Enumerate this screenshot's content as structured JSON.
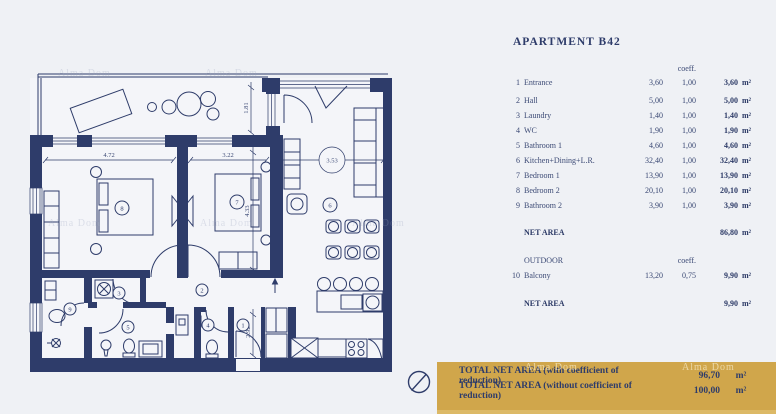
{
  "title": "APARTMENT B42",
  "watermark": "Alma Dom",
  "colors": {
    "wall_navy": "#2e3c6a",
    "banner_gold": "#d0a64b",
    "text_navy": "#3c4a75"
  },
  "table": {
    "coeff_header": "coeff.",
    "unit": "m²",
    "rows": [
      {
        "num": "1",
        "name": "Entrance",
        "area": "3,60",
        "coeff": "1,00",
        "net": "3,60"
      },
      {
        "num": "2",
        "name": "Hall",
        "area": "5,00",
        "coeff": "1,00",
        "net": "5,00"
      },
      {
        "num": "3",
        "name": "Laundry",
        "area": "1,40",
        "coeff": "1,00",
        "net": "1,40"
      },
      {
        "num": "4",
        "name": "WC",
        "area": "1,90",
        "coeff": "1,00",
        "net": "1,90"
      },
      {
        "num": "5",
        "name": "Bathroom 1",
        "area": "4,60",
        "coeff": "1,00",
        "net": "4,60"
      },
      {
        "num": "6",
        "name": "Kitchen+Dining+L.R.",
        "area": "32,40",
        "coeff": "1,00",
        "net": "32,40"
      },
      {
        "num": "7",
        "name": "Bedroom 1",
        "area": "13,90",
        "coeff": "1,00",
        "net": "13,90"
      },
      {
        "num": "8",
        "name": "Bedroom 2",
        "area": "20,10",
        "coeff": "1,00",
        "net": "20,10"
      },
      {
        "num": "9",
        "name": "Bathroom 2",
        "area": "3,90",
        "coeff": "1,00",
        "net": "3,90"
      }
    ],
    "net_area_label": "NET AREA",
    "net_area_value": "86,80",
    "outdoor_label": "OUTDOOR",
    "outdoor_coeff_header": "coeff.",
    "outdoor_row": {
      "num": "10",
      "name": "Balcony",
      "area": "13,20",
      "coeff": "0,75",
      "net": "9,90"
    },
    "outdoor_net_label": "NET AREA",
    "outdoor_net_value": "9,90"
  },
  "banner": {
    "line1_label": "TOTAL NET AREA (with coefficient of reduction)",
    "line1_value": "96,70",
    "line2_label": "TOTAL NET AREA (without coefficient of reduction)",
    "line2_value": "100,00",
    "unit": "m²"
  },
  "floorplan": {
    "dimensions": [
      "4.72",
      "3.22",
      "3.53",
      "1.81",
      "4.33",
      "2.92"
    ],
    "room_numbers": [
      "1",
      "2",
      "3",
      "4",
      "5",
      "6",
      "7",
      "8",
      "9"
    ]
  }
}
